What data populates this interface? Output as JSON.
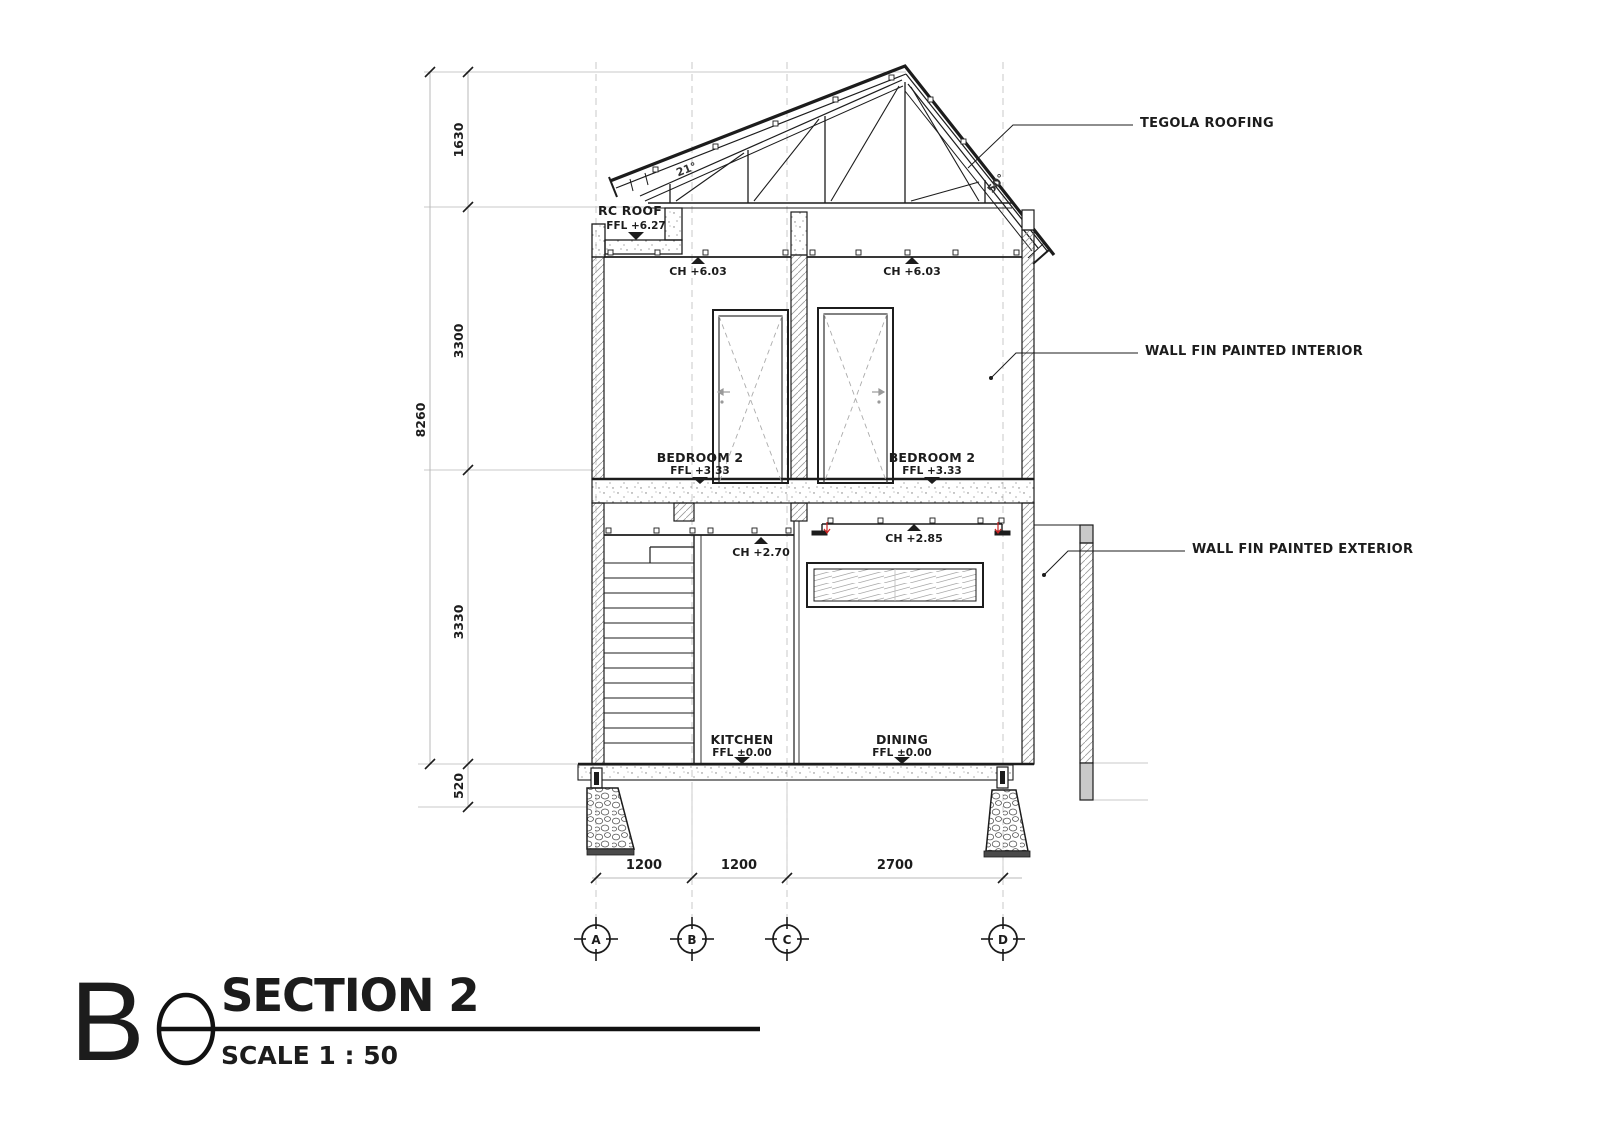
{
  "annotations": {
    "tegola": "TEGOLA ROOFING",
    "wall_int": "WALL FIN PAINTED INTERIOR",
    "wall_ext": "WALL FIN PAINTED EXTERIOR"
  },
  "levels": {
    "rc_roof": {
      "name": "RC ROOF",
      "ffl": "FFL +6.27"
    },
    "ch_upper": [
      "CH +6.03",
      "CH +6.03"
    ],
    "ch_kitchen": "CH +2.70",
    "ch_dining": "CH +2.85"
  },
  "rooms": {
    "bedroom_left": {
      "name": "BEDROOM 2",
      "ffl": "FFL +3.33"
    },
    "bedroom_right": {
      "name": "BEDROOM 2",
      "ffl": "FFL +3.33"
    },
    "kitchen": {
      "name": "KITCHEN",
      "ffl": "FFL ±0.00"
    },
    "dining": {
      "name": "DINING",
      "ffl": "FFL ±0.00"
    }
  },
  "angles": {
    "left": "21°",
    "right": "50°"
  },
  "dims_vertical": {
    "total": "8260",
    "segments": [
      "1630",
      "3300",
      "3330",
      "520"
    ]
  },
  "dims_horizontal": [
    "1200",
    "1200",
    "2700"
  ],
  "grid": [
    "A",
    "B",
    "C",
    "D"
  ],
  "titleblock": {
    "letter": "B",
    "title": "SECTION 2",
    "scale": "SCALE 1 : 50"
  },
  "colors": {
    "line": "#1c1c1c",
    "light": "#c3c3c3",
    "hatch": "#999999",
    "red": "#cc2222",
    "gray_fill": "#c9c9c9"
  }
}
